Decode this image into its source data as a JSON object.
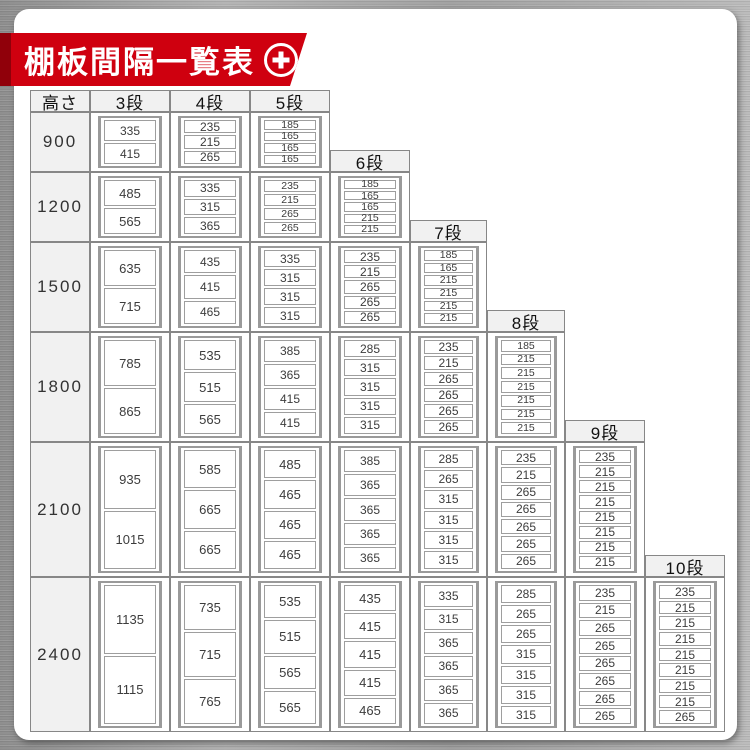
{
  "banner": {
    "title": "棚板間隔一覧表",
    "plus_icon": "plus-icon"
  },
  "colors": {
    "accent_red": "#cf000f",
    "accent_red_dark": "#8d0a12",
    "table_border_grey": "#878787",
    "header_bg_grey": "#f1f1f1",
    "card_white": "#ffffff",
    "metal_grey": "#a8a8a8"
  },
  "chart_data": {
    "type": "table",
    "title": "棚板間隔一覧表",
    "row_header": "高さ",
    "column_unit_suffix": "段",
    "columns": [
      "3段",
      "4段",
      "5段",
      "6段",
      "7段",
      "8段",
      "9段",
      "10段"
    ],
    "layout_note": "staircase table: each tier column starts at the first height row that has data for it; its header sits at the bottom of the previous row",
    "rows": [
      {
        "height": "900",
        "intervals": {
          "3段": [
            335,
            415
          ],
          "4段": [
            235,
            215,
            265
          ],
          "5段": [
            185,
            165,
            165,
            165
          ]
        }
      },
      {
        "height": "1200",
        "intervals": {
          "3段": [
            485,
            565
          ],
          "4段": [
            335,
            315,
            365
          ],
          "5段": [
            235,
            215,
            265,
            265
          ],
          "6段": [
            185,
            165,
            165,
            215,
            215
          ]
        }
      },
      {
        "height": "1500",
        "intervals": {
          "3段": [
            635,
            715
          ],
          "4段": [
            435,
            415,
            465
          ],
          "5段": [
            335,
            315,
            315,
            315
          ],
          "6段": [
            235,
            215,
            265,
            265,
            265
          ],
          "7段": [
            185,
            165,
            215,
            215,
            215,
            215
          ]
        }
      },
      {
        "height": "1800",
        "intervals": {
          "3段": [
            785,
            865
          ],
          "4段": [
            535,
            515,
            565
          ],
          "5段": [
            385,
            365,
            415,
            415
          ],
          "6段": [
            285,
            315,
            315,
            315,
            315
          ],
          "7段": [
            235,
            215,
            265,
            265,
            265,
            265
          ],
          "8段": [
            185,
            215,
            215,
            215,
            215,
            215,
            215
          ]
        }
      },
      {
        "height": "2100",
        "intervals": {
          "3段": [
            935,
            1015
          ],
          "4段": [
            585,
            665,
            665
          ],
          "5段": [
            485,
            465,
            465,
            465
          ],
          "6段": [
            385,
            365,
            365,
            365,
            365
          ],
          "7段": [
            285,
            265,
            315,
            315,
            315,
            315
          ],
          "8段": [
            235,
            215,
            265,
            265,
            265,
            265,
            265
          ],
          "9段": [
            235,
            215,
            215,
            215,
            215,
            215,
            215,
            215
          ]
        }
      },
      {
        "height": "2400",
        "intervals": {
          "3段": [
            1135,
            1115
          ],
          "4段": [
            735,
            715,
            765
          ],
          "5段": [
            535,
            515,
            565,
            565
          ],
          "6段": [
            435,
            415,
            415,
            415,
            465
          ],
          "7段": [
            335,
            315,
            365,
            365,
            365,
            365
          ],
          "8段": [
            285,
            265,
            265,
            315,
            315,
            315,
            315
          ],
          "9段": [
            235,
            215,
            265,
            265,
            265,
            265,
            265,
            265
          ],
          "10段": [
            235,
            215,
            215,
            215,
            215,
            215,
            215,
            215,
            265
          ]
        }
      }
    ]
  }
}
